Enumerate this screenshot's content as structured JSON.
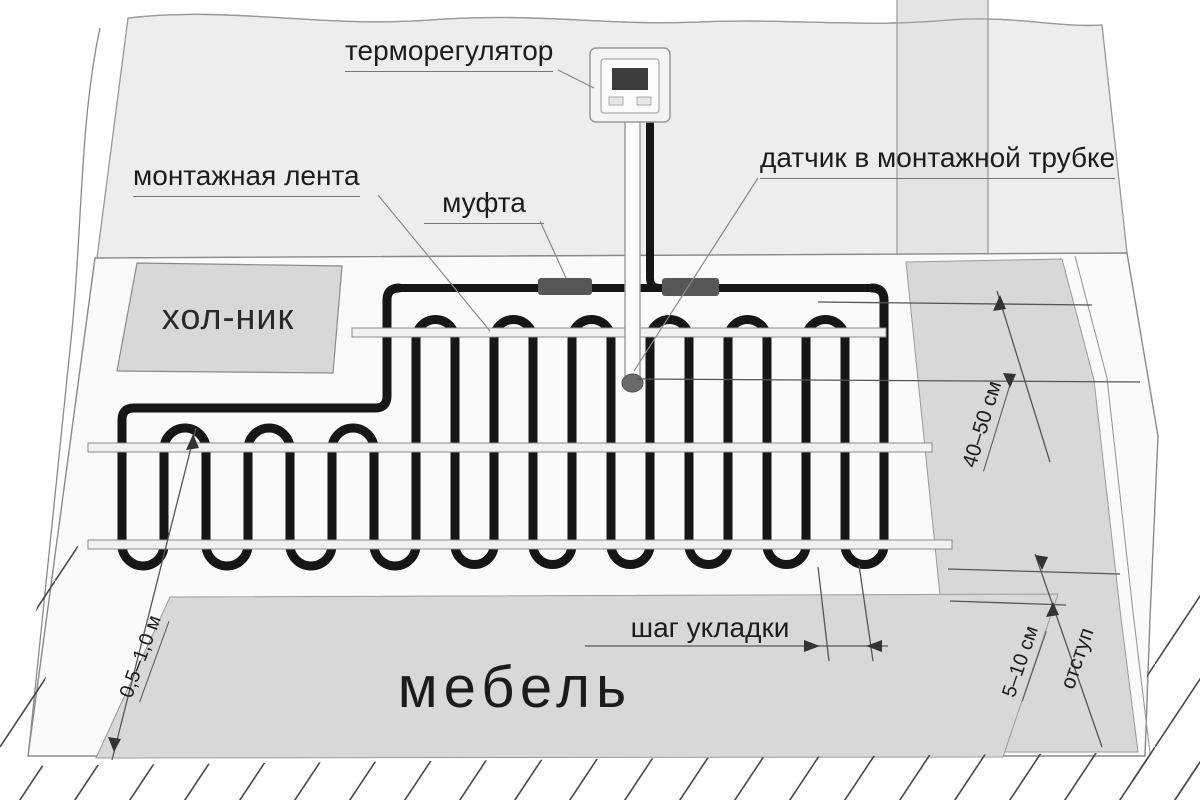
{
  "diagram": {
    "labels": {
      "thermostat": "терморегулятор",
      "mounting_tape": "монтажная лента",
      "coupling": "муфта",
      "sensor": "датчик в монтажной трубке",
      "fridge": "хол-ник",
      "furniture": "мебель",
      "laying_step": "шаг укладки"
    },
    "dimensions": {
      "sensor_depth": "40–50 см",
      "furniture_clearance": "5–10 см",
      "offset": "отступ",
      "wall_clearance": "0,5–1,0 м"
    },
    "colors": {
      "cable": "#161616",
      "zone_fill": "#d8d8d8",
      "wall_fill": "#ededed",
      "coupling_fill": "#575757",
      "tape_fill": "#f1f1f1",
      "hatch_line": "#4a4a4a"
    }
  }
}
